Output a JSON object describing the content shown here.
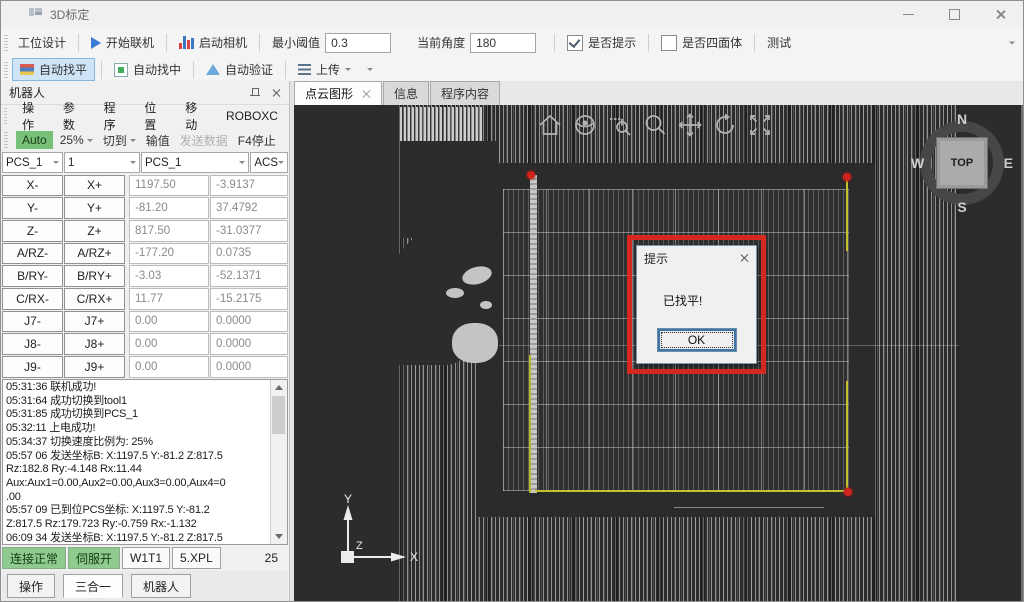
{
  "window": {
    "title": "3D标定"
  },
  "icons": [
    "app-icon",
    "minimize-icon",
    "maximize-icon",
    "close-icon",
    "play-icon",
    "bar-chart-icon",
    "checkbox-icon",
    "flag-level-icon",
    "square-center-icon",
    "triangle-verify-icon",
    "list-upload-icon",
    "dropdown-arrow-icon",
    "pin-icon",
    "panel-close-icon",
    "scroll-up-icon",
    "scroll-down-icon",
    "home-icon",
    "orbit-icon",
    "zoom-window-icon",
    "zoom-icon",
    "pan-icon",
    "rotate-icon",
    "zoom-extents-icon",
    "axes-triad-icon",
    "compass-icon"
  ],
  "toolbar_top": {
    "station_design": "工位设计",
    "start_online": "开始联机",
    "start_camera": "启动相机",
    "min_threshold": {
      "label": "最小阈值",
      "value": "0.3"
    },
    "current_angle": {
      "label": "当前角度",
      "value": "180"
    },
    "show_prompt_label": "是否提示",
    "tetrahedron_label": "是否四面体",
    "test": "测试"
  },
  "toolbar_auto": {
    "auto_level": "自动找平",
    "auto_center": "自动找中",
    "auto_verify": "自动验证",
    "upload": "上传"
  },
  "robot_panel": {
    "title": "机器人",
    "menu_items": [
      "操作",
      "参数",
      "程序",
      "位置",
      "移动",
      "ROBOXC"
    ],
    "action_bar": {
      "mode": "Auto",
      "speed": "25%",
      "switch_to": "切到",
      "input_value": "输值",
      "send_data": "发送数据",
      "f4_stop": "F4停止"
    },
    "selectors": [
      "PCS_1",
      "1",
      "PCS_1",
      "ACS"
    ],
    "jog_rows": [
      {
        "minus": "X-",
        "plus": "X+",
        "pos": "1197.50",
        "val": "-3.9137"
      },
      {
        "minus": "Y-",
        "plus": "Y+",
        "pos": "-81.20",
        "val": "37.4792"
      },
      {
        "minus": "Z-",
        "plus": "Z+",
        "pos": "817.50",
        "val": "-31.0377"
      },
      {
        "minus": "A/RZ-",
        "plus": "A/RZ+",
        "pos": "-177.20",
        "val": "0.0735"
      },
      {
        "minus": "B/RY-",
        "plus": "B/RY+",
        "pos": "-3.03",
        "val": "-52.1371"
      },
      {
        "minus": "C/RX-",
        "plus": "C/RX+",
        "pos": "11.77",
        "val": "-15.2175"
      },
      {
        "minus": "J7-",
        "plus": "J7+",
        "pos": "0.00",
        "val": "0.0000"
      },
      {
        "minus": "J8-",
        "plus": "J8+",
        "pos": "0.00",
        "val": "0.0000"
      },
      {
        "minus": "J9-",
        "plus": "J9+",
        "pos": "0.00",
        "val": "0.0000"
      }
    ],
    "log_lines": [
      "05:31:36 联机成功!",
      "05:31:64 成功切换到tool1",
      "05:31:85 成功切换到PCS_1",
      "05:32:11 上电成功!",
      "05:34:37 切换速度比例为: 25%",
      "05:57 06 发送坐标B:  X:1197.5 Y:-81.2 Z:817.5",
      "Rz:182.8 Ry:-4.148 Rx:11.44",
      "Aux:Aux1=0.00,Aux2=0.00,Aux3=0.00,Aux4=0",
      ".00",
      "05:57 09 已到位PCS坐标:  X:1197.5 Y:-81.2",
      "Z:817.5 Rz:179.723 Ry:-0.759 Rx:-1.132",
      "06:09 34 发送坐标B:  X:1197.5 Y:-81.2 Z:817.5"
    ],
    "status_bar": {
      "connection": "连接正常",
      "servo": "伺服开",
      "tool": "W1T1",
      "file": "5.XPL",
      "speed": "25"
    },
    "bottom_tabs": [
      "操作",
      "三合一",
      "机器人"
    ]
  },
  "main_area": {
    "tabs": [
      {
        "label": "点云图形"
      },
      {
        "label": "信息"
      },
      {
        "label": "程序内容"
      }
    ],
    "active_tab": "点云图形",
    "viewport": {
      "toolbar_icons": [
        "home",
        "orbit",
        "zoom-window",
        "zoom",
        "pan",
        "rotate",
        "zoom-extents"
      ],
      "compass": {
        "north": "N",
        "east": "E",
        "south": "S",
        "west": "W",
        "center": "TOP"
      },
      "axes": {
        "x": "X",
        "y": "Y",
        "z": "Z"
      },
      "dialog": {
        "title": "提示",
        "message": "已找平!",
        "ok_label": "OK"
      }
    }
  },
  "colors": {
    "highlight_red": "#d6281e",
    "corner_dot_red": "#cf231d",
    "edge_yellow": "#c3c32e",
    "status_green": "#8fca8f",
    "auto_mode_green": "#77c077",
    "selected_button_blue": "#cfe4f7",
    "viewport_background": "#2c2c2c"
  }
}
